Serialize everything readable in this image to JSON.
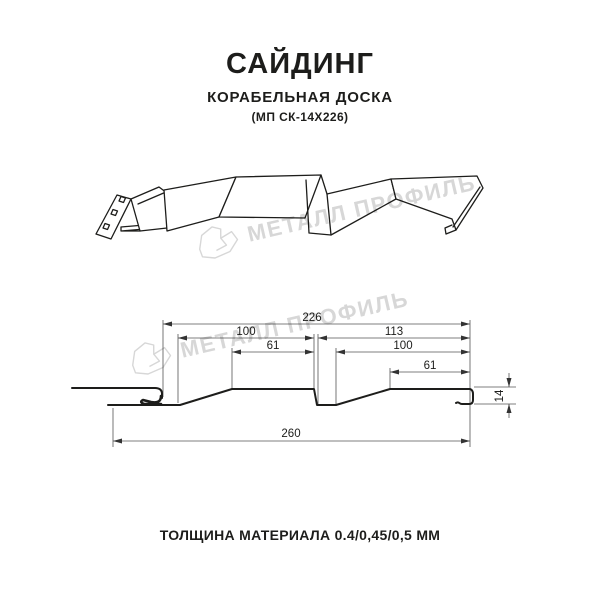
{
  "header": {
    "title": "САЙДИНГ",
    "subtitle": "КОРАБЕЛЬНАЯ ДОСКА",
    "model": "(МП СК-14Х226)"
  },
  "watermark": {
    "text": "МЕТАЛЛ ПРОФИЛЬ",
    "color": "#d7d7d7"
  },
  "diagram": {
    "dims": {
      "width_top": "226",
      "left_flat": "100",
      "left_inner": "61",
      "right_top": "113",
      "right_flat": "100",
      "right_inner": "61",
      "total_width": "260",
      "height": "14"
    }
  },
  "footer": {
    "text": "ТОЛЩИНА МАТЕРИАЛА 0.4/0,45/0,5 ММ"
  }
}
